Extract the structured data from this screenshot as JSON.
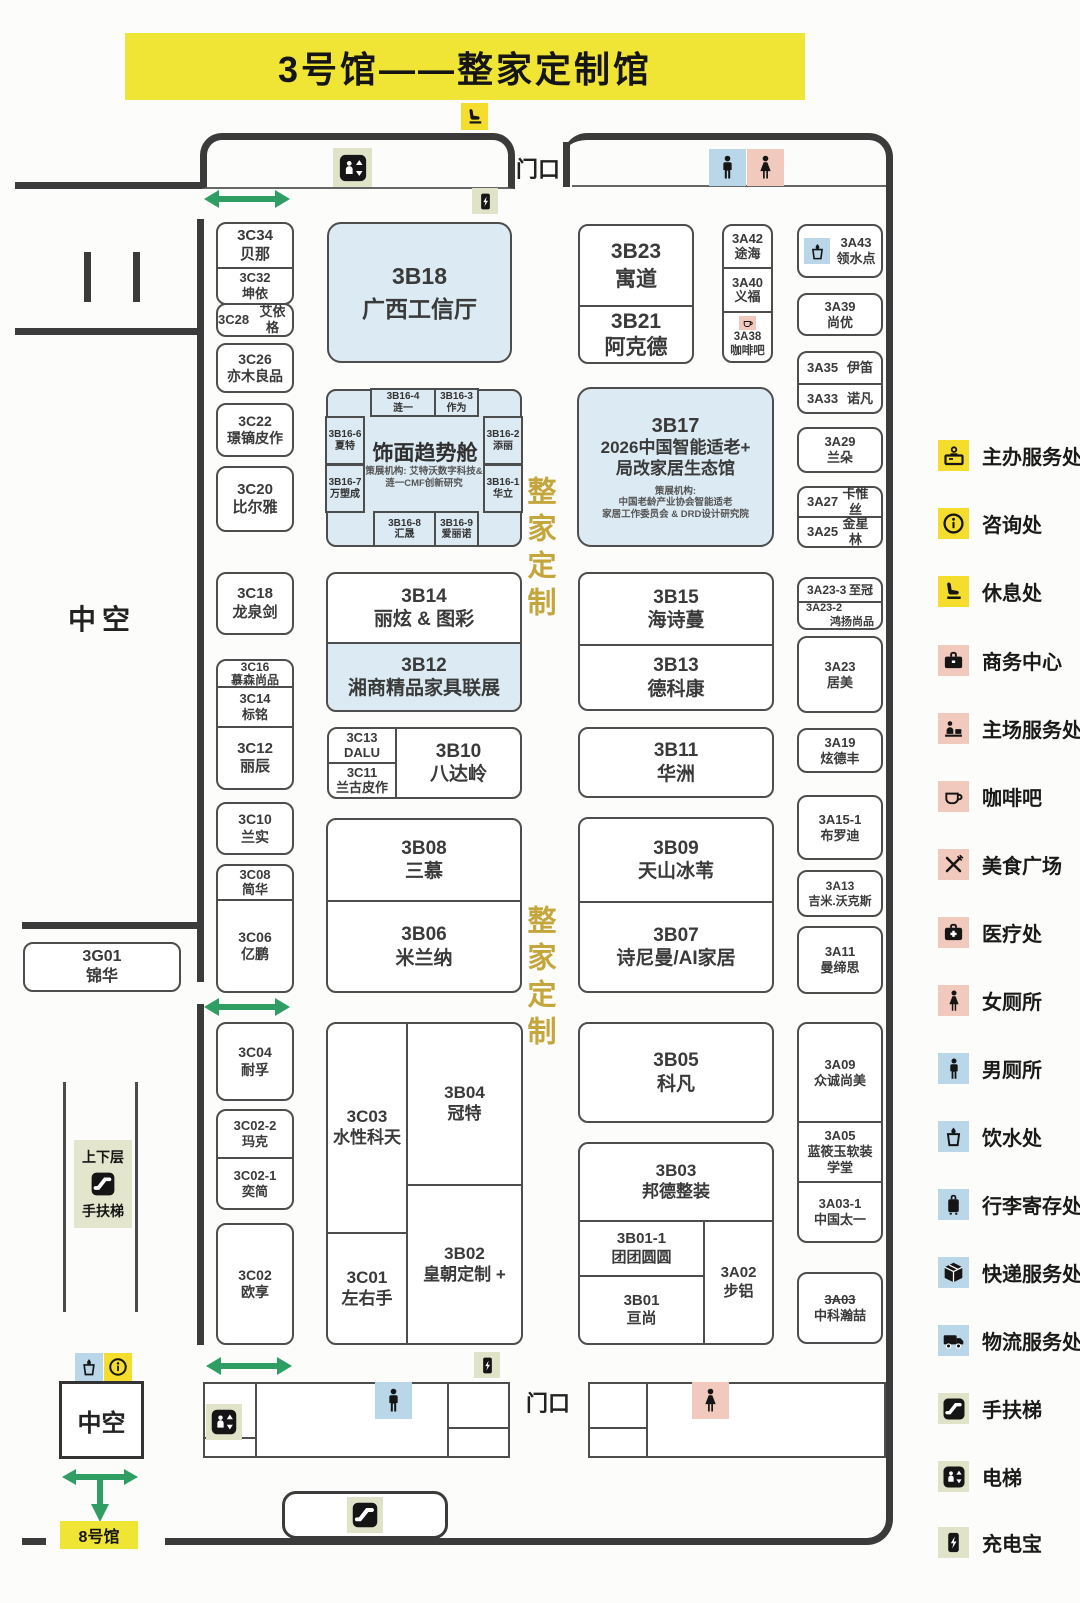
{
  "title": "3号馆——整家定制馆",
  "labels": {
    "entrance_top": "门口",
    "entrance_bottom": "门口",
    "atrium_side": "中空",
    "atrium_bottom": "中空",
    "hall8": "8号馆",
    "escalator_top": "上下层",
    "escalator_bottom": "手扶梯",
    "zone_vertical_1": "整家定制",
    "zone_vertical_2": "整家定制"
  },
  "colors": {
    "banner_yellow": "#f0e435",
    "booth_highlight_blue": "#dcebf3",
    "legend_yellow": "#f5dd2e",
    "legend_pink": "#f2c9bd",
    "legend_blue": "#b9d7e9",
    "legend_olive": "#e0e3c8",
    "arrow_green": "#2f9e63",
    "zone_text_gold": "#c5a63c"
  },
  "facade": {
    "title": "饰面趋势舱",
    "sub1": "策展机构: 艾特沃数字科技&",
    "sub2": "涟一CMF创新研究"
  },
  "booths": {
    "b3C34": {
      "id": "3C34",
      "name": "贝那"
    },
    "b3C32": {
      "id": "3C32",
      "name": "坤依"
    },
    "b3C28": {
      "id": "3C28",
      "name": "艾依格"
    },
    "b3C26": {
      "id": "3C26",
      "name": "亦木良品"
    },
    "b3C22": {
      "id": "3C22",
      "name": "璟镝皮作"
    },
    "b3C20": {
      "id": "3C20",
      "name": "比尔雅"
    },
    "b3C18": {
      "id": "3C18",
      "name": "龙泉剑"
    },
    "b3C16": {
      "id": "3C16",
      "name": "慕森尚品"
    },
    "b3C14": {
      "id": "3C14",
      "name": "标铭"
    },
    "b3C12": {
      "id": "3C12",
      "name": "丽辰"
    },
    "b3C10": {
      "id": "3C10",
      "name": "兰实"
    },
    "b3C08": {
      "id": "3C08",
      "name": "简华"
    },
    "b3C06": {
      "id": "3C06",
      "name": "亿鹏"
    },
    "b3C04": {
      "id": "3C04",
      "name": "耐孚"
    },
    "b3C02_2": {
      "id": "3C02-2",
      "name": "玛克"
    },
    "b3C02_1": {
      "id": "3C02-1",
      "name": "奕简"
    },
    "b3C02": {
      "id": "3C02",
      "name": "欧享"
    },
    "b3C03": {
      "id": "3C03",
      "name": "水性科天"
    },
    "b3C01": {
      "id": "3C01",
      "name": "左右手"
    },
    "b3C13": {
      "id": "3C13",
      "name": "DALU"
    },
    "b3C11": {
      "id": "3C11",
      "name": "兰古皮作"
    },
    "b3G01": {
      "id": "3G01",
      "name": "锦华"
    },
    "b3B18": {
      "id": "3B18",
      "name": "广西工信厅"
    },
    "b3B23": {
      "id": "3B23",
      "name": "寓道"
    },
    "b3B21": {
      "id": "3B21",
      "name": "阿克德"
    },
    "b3B16_4": {
      "id": "3B16-4",
      "name": "涟一"
    },
    "b3B16_3": {
      "id": "3B16-3",
      "name": "作为"
    },
    "b3B16_6": {
      "id": "3B16-6",
      "name": "夏特"
    },
    "b3B16_2": {
      "id": "3B16-2",
      "name": "添丽"
    },
    "b3B16_7": {
      "id": "3B16-7",
      "name": "万塑成"
    },
    "b3B16_1": {
      "id": "3B16-1",
      "name": "华立"
    },
    "b3B16_8": {
      "id": "3B16-8",
      "name": "汇晟"
    },
    "b3B16_9": {
      "id": "3B16-9",
      "name": "爱丽诺"
    },
    "b3B17": {
      "id": "3B17",
      "line1": "2026中国智能适老+",
      "line2": "局改家居生态馆",
      "sub1": "策展机构:",
      "sub2": "中国老龄产业协会智能适老",
      "sub3": "家居工作委员会 & DRD设计研究院"
    },
    "b3B15": {
      "id": "3B15",
      "name": "海诗蔓"
    },
    "b3B14": {
      "id": "3B14",
      "name": "丽炫 & 图彩"
    },
    "b3B13": {
      "id": "3B13",
      "name": "德科康"
    },
    "b3B12": {
      "id": "3B12",
      "name": "湘商精品家具联展"
    },
    "b3B11": {
      "id": "3B11",
      "name": "华洲"
    },
    "b3B10": {
      "id": "3B10",
      "name": "八达岭"
    },
    "b3B09": {
      "id": "3B09",
      "name": "天山冰苇"
    },
    "b3B08": {
      "id": "3B08",
      "name": "三慕"
    },
    "b3B07": {
      "id": "3B07",
      "name": "诗尼曼/AI家居"
    },
    "b3B06": {
      "id": "3B06",
      "name": "米兰纳"
    },
    "b3B05": {
      "id": "3B05",
      "name": "科凡"
    },
    "b3B04": {
      "id": "3B04",
      "name": "冠特"
    },
    "b3B03": {
      "id": "3B03",
      "name": "邦德整装"
    },
    "b3B02": {
      "id": "3B02",
      "name": "皇朝定制 +"
    },
    "b3B01_1": {
      "id": "3B01-1",
      "name": "团团圆圆"
    },
    "b3B01": {
      "id": "3B01",
      "name": "亘尚"
    },
    "b3A42": {
      "id": "3A42",
      "name": "途海"
    },
    "b3A40": {
      "id": "3A40",
      "name": "义福"
    },
    "b3A38": {
      "id": "3A38",
      "name": "咖啡吧"
    },
    "b3A43": {
      "id": "3A43",
      "name": "领水点"
    },
    "b3A39": {
      "id": "3A39",
      "name": "尚优"
    },
    "b3A35": {
      "id": "3A35",
      "name": "伊笛"
    },
    "b3A33": {
      "id": "3A33",
      "name": "诺凡"
    },
    "b3A29": {
      "id": "3A29",
      "name": "兰朵"
    },
    "b3A27": {
      "id": "3A27",
      "name": "卡惟丝"
    },
    "b3A25": {
      "id": "3A25",
      "name": "金星林"
    },
    "b3A23_3": {
      "id": "3A23-3",
      "name": "至冠"
    },
    "b3A23_2": {
      "id": "3A23-2",
      "name": "鸿扬尚品"
    },
    "b3A23": {
      "id": "3A23",
      "name": "居美"
    },
    "b3A19": {
      "id": "3A19",
      "name": "炫德丰"
    },
    "b3A15_1": {
      "id": "3A15-1",
      "name": "布罗迪"
    },
    "b3A13": {
      "id": "3A13",
      "name": "吉米.沃克斯"
    },
    "b3A11": {
      "id": "3A11",
      "name": "曼缔思"
    },
    "b3A09": {
      "id": "3A09",
      "name": "众诚尚美"
    },
    "b3A05": {
      "id": "3A05",
      "name": "蓝筱玉软装学堂"
    },
    "b3A03_1": {
      "id": "3A03-1",
      "name": "中国太一"
    },
    "b3A02": {
      "id": "3A02",
      "name": "步铝"
    },
    "b3A03": {
      "id": "3A03",
      "name": "中科瀚喆"
    }
  },
  "legend": [
    {
      "icon": "reception-desk-icon",
      "label": "主办服务处",
      "bg": "#f5dd2e"
    },
    {
      "icon": "info-icon",
      "label": "咨询处",
      "bg": "#f5dd2e"
    },
    {
      "icon": "rest-seat-icon",
      "label": "休息处",
      "bg": "#f5dd2e"
    },
    {
      "icon": "briefcase-icon",
      "label": "商务中心",
      "bg": "#f2c9bd"
    },
    {
      "icon": "service-desk-icon",
      "label": "主场服务处",
      "bg": "#f2c9bd"
    },
    {
      "icon": "coffee-icon",
      "label": "咖啡吧",
      "bg": "#f2c9bd"
    },
    {
      "icon": "food-court-icon",
      "label": "美食广场",
      "bg": "#f2c9bd"
    },
    {
      "icon": "medical-icon",
      "label": "医疗处",
      "bg": "#f2c9bd"
    },
    {
      "icon": "female-icon",
      "label": "女厕所",
      "bg": "#f2c9bd"
    },
    {
      "icon": "male-icon",
      "label": "男厕所",
      "bg": "#b9d7e9"
    },
    {
      "icon": "water-icon",
      "label": "饮水处",
      "bg": "#b9d7e9"
    },
    {
      "icon": "luggage-icon",
      "label": "行李寄存处",
      "bg": "#b9d7e9"
    },
    {
      "icon": "parcel-icon",
      "label": "快递服务处",
      "bg": "#b9d7e9"
    },
    {
      "icon": "truck-icon",
      "label": "物流服务处",
      "bg": "#b9d7e9"
    },
    {
      "icon": "escalator-icon",
      "label": "手扶梯",
      "bg": "#e0e3c8"
    },
    {
      "icon": "elevator-icon",
      "label": "电梯",
      "bg": "#e0e3c8"
    },
    {
      "icon": "powerbank-icon",
      "label": "充电宝",
      "bg": "#e0e3c8"
    }
  ]
}
